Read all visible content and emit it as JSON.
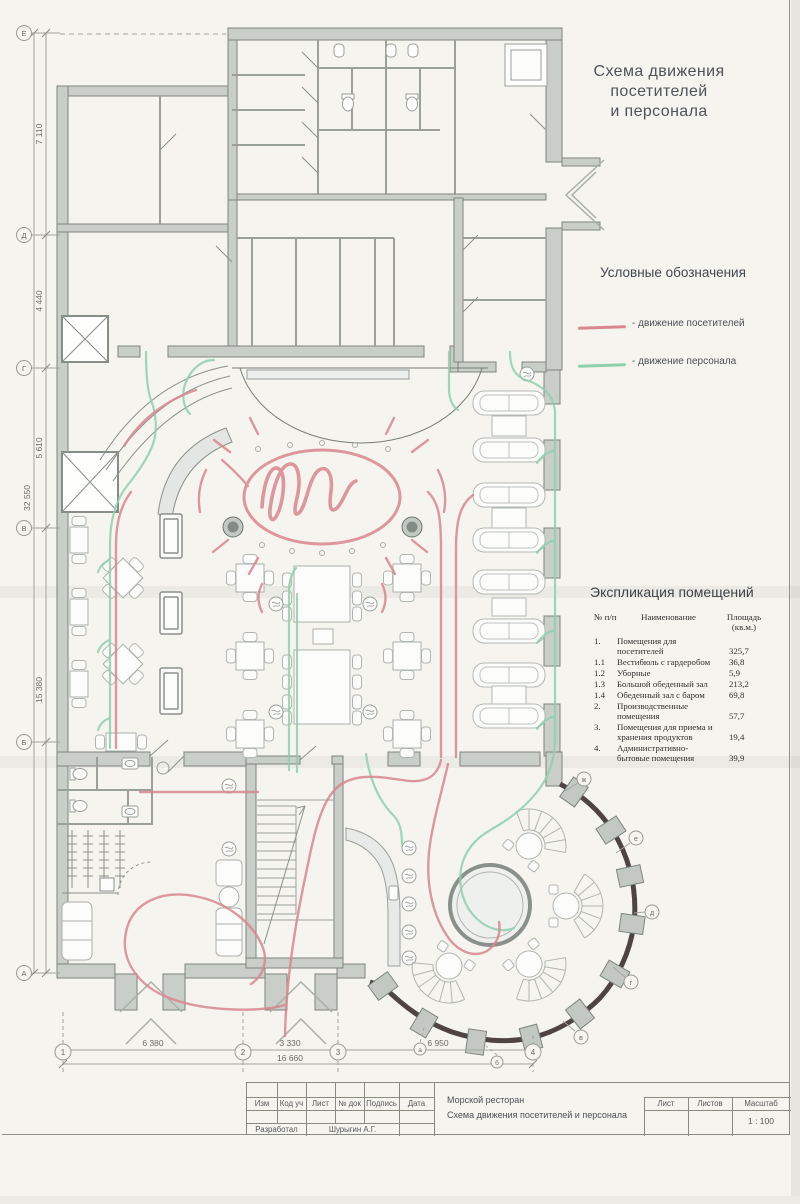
{
  "title": {
    "line1": "Схема движения",
    "line2": "посетителей",
    "line3": "и персонала"
  },
  "legend": {
    "title": "Условные обозначения",
    "items": [
      {
        "name": "visitors",
        "label": "- движение посетителей"
      },
      {
        "name": "staff",
        "label": "- движение персонала"
      }
    ]
  },
  "explication": {
    "title": "Экспликация помещений",
    "col_num": "№ п/п",
    "col_name": "Наименование",
    "col_area": "Площадь (кв.м.)",
    "rows": [
      {
        "num": "1.",
        "name": "Помещения для посетителей",
        "area": "325,7"
      },
      {
        "num": "1.1",
        "name": "Вестибюль с гардеробом",
        "area": "36,8"
      },
      {
        "num": "1.2",
        "name": "Уборные",
        "area": "5,9"
      },
      {
        "num": "1.3",
        "name": "Большой обеденный зал",
        "area": "213,2"
      },
      {
        "num": "1.4",
        "name": "Обеденный зал с баром",
        "area": "69,8"
      },
      {
        "num": "2.",
        "name": "Производственные помещения",
        "area": "57,7"
      },
      {
        "num": "3.",
        "name": "Помещения для приема и хранения продуктов",
        "area": "19,4"
      },
      {
        "num": "4.",
        "name": "Административно-бытовые помещения",
        "area": "39,9"
      }
    ]
  },
  "dimensions": {
    "left": [
      "7 110",
      "4 440",
      "5 610",
      "15 380"
    ],
    "left_total": "32 550",
    "bottom": [
      "6 380",
      "3 330",
      "6 950"
    ],
    "bottom_total": "16 660"
  },
  "grid": {
    "left": [
      "Е",
      "Д",
      "Г",
      "В",
      "Б",
      "А"
    ],
    "bottom": [
      "1",
      "2",
      "3",
      "4"
    ],
    "right": [
      "ж",
      "е",
      "д",
      "г",
      "в"
    ],
    "radial": [
      "а",
      "б"
    ]
  },
  "stamp": {
    "cols": [
      "Изм",
      "Код уч",
      "Лист",
      "№ док",
      "Подпись",
      "Дата"
    ],
    "developed_label": "Разработал",
    "developed_name": "Шурыгин А.Г.",
    "project_line1": "Морской ресторан",
    "project_line2": "Схема движения посетителей и персонала",
    "sheet_label": "Лист",
    "sheets_label": "Листов",
    "scale_label": "Масштаб",
    "scale_value": "1 : 100"
  },
  "colors": {
    "visitors": "#d9868f",
    "staff": "#8fd0ae",
    "walls": "#c9cec9",
    "bay_wall": "#4f4444"
  }
}
